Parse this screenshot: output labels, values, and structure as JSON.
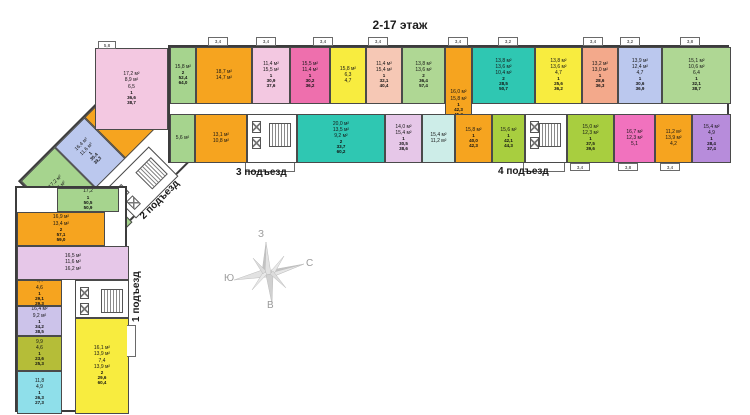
{
  "title": "2-17 этаж",
  "entrance_labels": {
    "e1": "1 подъезд",
    "e2": "2 подъезд",
    "e3": "3 подъезд",
    "e4": "4 подъезд"
  },
  "compass": {
    "top": "З",
    "right": "С",
    "left": "Ю",
    "bottom": "В"
  },
  "palette": {
    "wall": "#3c3c3c",
    "orange": "#F6A41F",
    "lightpink": "#F3C8E1",
    "hotpink": "#EE6FAD",
    "yellow": "#F8EC3F",
    "peach": "#F6C8B5",
    "coral": "#F3A98B",
    "lightgreen": "#AFD794",
    "green": "#A6D48E",
    "lime": "#A8CE3F",
    "olive": "#B5BD38",
    "teal": "#2FC7B2",
    "palecyan": "#CDEDE8",
    "cyan": "#8FDFEA",
    "periwinkle": "#BBC8EE",
    "lavender": "#CCC3EA",
    "lilac": "#E6C7E8",
    "purple": "#B78CDB",
    "magenta": "#F172BE"
  },
  "plan": {
    "top_wing": {
      "rect": [
        168,
        45,
        561,
        118
      ],
      "cells": [
        {
          "c": "#A6D48E",
          "r": [
            0,
            0,
            26,
            57
          ],
          "l": [
            "15,8 м²"
          ],
          "t": "2\n52,4\n64,0"
        },
        {
          "c": "#F6A41F",
          "r": [
            26,
            0,
            56,
            57
          ],
          "l": [
            "18,7 м²",
            "14,7 м²"
          ],
          "t": ""
        },
        {
          "c": "#F3C8E1",
          "r": [
            82,
            0,
            38,
            57
          ],
          "l": [
            "11,4 м²",
            "15,5 м²"
          ],
          "t": "1\n30,9\n37,6"
        },
        {
          "c": "#EE6FAD",
          "r": [
            120,
            0,
            40,
            57
          ],
          "l": [
            "15,5 м²",
            "11,4 м²"
          ],
          "t": "1\n30,2\n36,2"
        },
        {
          "c": "#F8EC3F",
          "r": [
            160,
            0,
            36,
            57
          ],
          "l": [
            "15,8 м²",
            "6,3",
            "4,7"
          ],
          "t": ""
        },
        {
          "c": "#F6C8B5",
          "r": [
            196,
            0,
            36,
            57
          ],
          "l": [
            "11,4 м²",
            "15,4 м²"
          ],
          "t": "1\n32,1\n40,4"
        },
        {
          "c": "#AFD794",
          "r": [
            232,
            0,
            43,
            57
          ],
          "l": [
            "13,8 м²",
            "13,6 м²"
          ],
          "t": "2\n36,4\n57,4"
        },
        {
          "c": "#F6A41F",
          "r": [
            275,
            0,
            27,
            114
          ],
          "l": [
            "16,0 м²",
            "15,8 м²"
          ],
          "t": "1\n42,3\n45,3"
        },
        {
          "c": "#2FC7B2",
          "r": [
            302,
            0,
            63,
            57
          ],
          "l": [
            "13,8 м²",
            "13,6 м²",
            "10,4 м²"
          ],
          "t": "2\n28,5\n50,7"
        },
        {
          "c": "#F8EC3F",
          "r": [
            365,
            0,
            47,
            57
          ],
          "l": [
            "13,8 м²",
            "13,6 м²",
            "4,7"
          ],
          "t": "1\n25,6\n36,2"
        },
        {
          "c": "#F3A98B",
          "r": [
            412,
            0,
            36,
            57
          ],
          "l": [
            "13,2 м²",
            "13,0 м²"
          ],
          "t": "1\n28,6\n36,3"
        },
        {
          "c": "#BBC8EE",
          "r": [
            448,
            0,
            44,
            57
          ],
          "l": [
            "13,9 м²",
            "12,4 м²",
            "4,7"
          ],
          "t": "1\n30,6\n36,9"
        },
        {
          "c": "#AFD794",
          "r": [
            492,
            0,
            69,
            57
          ],
          "l": [
            "15,1 м²",
            "10,6 м²",
            "6,4"
          ],
          "t": "1\n32,1\n38,7"
        },
        {
          "c": "#A6D48E",
          "r": [
            0,
            67,
            25,
            49
          ],
          "l": [
            "5,6 м²"
          ],
          "t": ""
        },
        {
          "c": "#F6A41F",
          "r": [
            25,
            67,
            52,
            49
          ],
          "l": [
            "13,1 м²",
            "10,8 м²"
          ],
          "t": ""
        },
        {
          "c": "#2FC7B2",
          "r": [
            127,
            67,
            88,
            49
          ],
          "l": [
            "20,0 м²",
            "13,5 м²",
            "9,2 м²"
          ],
          "t": "2\n33,7\n60,2"
        },
        {
          "c": "#E6C7E8",
          "r": [
            215,
            67,
            37,
            49
          ],
          "l": [
            "14,0 м²",
            "15,4 м²"
          ],
          "t": "1\n30,5\n38,6"
        },
        {
          "c": "#CDEDE8",
          "r": [
            252,
            67,
            33,
            49
          ],
          "l": [
            "15,4 м²",
            "11,2 м²"
          ],
          "t": ""
        },
        {
          "c": "#F6A41F",
          "r": [
            285,
            67,
            37,
            49
          ],
          "l": [
            "15,8 м²"
          ],
          "t": "1\n40,0\n42,3"
        },
        {
          "c": "#A8CE3F",
          "r": [
            322,
            67,
            33,
            49
          ],
          "l": [
            "15,6 м²"
          ],
          "t": "1\n42,1\n44,3"
        },
        {
          "c": "#A8CE3F",
          "r": [
            397,
            67,
            47,
            49
          ],
          "l": [
            "15,0 м²",
            "12,3 м²"
          ],
          "t": "1\n37,5\n39,6"
        },
        {
          "c": "#F172BE",
          "r": [
            444,
            67,
            41,
            49
          ],
          "l": [
            "16,7 м²",
            "12,3 м²",
            "5,1"
          ],
          "t": ""
        },
        {
          "c": "#F6A41F",
          "r": [
            485,
            67,
            37,
            49
          ],
          "l": [
            "11,2 м²",
            "13,9 м²",
            "4,2"
          ],
          "t": ""
        },
        {
          "c": "#B78CDB",
          "r": [
            522,
            67,
            39,
            49
          ],
          "l": [
            "15,4 м²",
            "4,9"
          ],
          "t": "1\n28,4\n37,4"
        }
      ],
      "cores": [
        {
          "r": [
            77,
            67,
            50,
            49
          ]
        },
        {
          "r": [
            355,
            67,
            42,
            49
          ]
        }
      ],
      "balconies_top": [
        {
          "x": 40,
          "label": "3,4"
        },
        {
          "x": 88,
          "label": "3,4"
        },
        {
          "x": 145,
          "label": "3,4"
        },
        {
          "x": 200,
          "label": "3,4"
        },
        {
          "x": 280,
          "label": "3,4"
        },
        {
          "x": 330,
          "label": "3,2"
        },
        {
          "x": 415,
          "label": "3,4"
        },
        {
          "x": 452,
          "label": "3,2"
        },
        {
          "x": 512,
          "label": "3,8"
        }
      ],
      "balconies_bottom": [
        {
          "x": 402,
          "label": "3,4"
        },
        {
          "x": 450,
          "label": "3,8"
        },
        {
          "x": 492,
          "label": "3,4"
        }
      ]
    },
    "junction": {
      "cells": [
        {
          "c": "#F3C8E1",
          "r": [
            95,
            48,
            73,
            82
          ],
          "l": [
            "17,2 м²",
            "8,9 м²",
            "6,5"
          ],
          "t": "1\n36,6\n38,7"
        }
      ],
      "balconies": [
        {
          "r": [
            98,
            41,
            18,
            8
          ],
          "label": "5,8"
        }
      ]
    },
    "diagonal_wing": {
      "cells": [
        {
          "c": "#A6D48E",
          "r": [
            0,
            0,
            48,
            58
          ],
          "l": [
            "17,2 м²",
            "8,6 м²"
          ],
          "t": ""
        },
        {
          "c": "#BBC8EE",
          "r": [
            48,
            0,
            42,
            58
          ],
          "l": [
            "16,4 м²",
            "11,6 м²"
          ],
          "t": "1\n35,4\n39,3"
        },
        {
          "c": "#F6A41F",
          "r": [
            90,
            0,
            45,
            58
          ],
          "l": [
            "16,5 м²",
            "11,6 м²",
            "4,3"
          ],
          "t": ""
        },
        {
          "c": "#A6D48E",
          "r": [
            0,
            66,
            50,
            42
          ],
          "l": [
            "5,8 м²"
          ],
          "t": ""
        }
      ],
      "cores": [
        {
          "r": [
            55,
            66,
            60,
            42
          ]
        }
      ]
    },
    "vertical_wing": {
      "cells": [
        {
          "c": "#A6D48E",
          "r": [
            40,
            0,
            62,
            24
          ],
          "l": [
            "17,2"
          ],
          "t": "1\n50,5\n50,9"
        },
        {
          "c": "#F6A41F",
          "r": [
            0,
            24,
            88,
            34
          ],
          "l": [
            "16,9 м²",
            "13,4 м²"
          ],
          "t": "2\n57,1\n59,0"
        },
        {
          "c": "#E6C7E8",
          "r": [
            0,
            58,
            112,
            34
          ],
          "l": [
            "16,5 м²",
            "11,6 м²",
            "16,2 м²"
          ],
          "t": ""
        },
        {
          "c": "#F6A41F",
          "r": [
            0,
            92,
            45,
            26
          ],
          "l": [
            "4,4",
            "4,6"
          ],
          "t": "1\n29,1\n29,3"
        },
        {
          "c": "#CCC3EA",
          "r": [
            0,
            118,
            45,
            30
          ],
          "l": [
            "16,4 м²",
            "9,2 м²"
          ],
          "t": "1\n34,2\n38,5"
        },
        {
          "c": "#B5BD38",
          "r": [
            0,
            148,
            45,
            35
          ],
          "l": [
            "9,9",
            "4,6"
          ],
          "t": "1\n23,6\n25,3"
        },
        {
          "c": "#8FDFEA",
          "r": [
            0,
            183,
            45,
            43
          ],
          "l": [
            "11,8",
            "4,9"
          ],
          "t": "1\n26,3\n27,3"
        },
        {
          "c": "#F8EC3F",
          "r": [
            58,
            130,
            54,
            96
          ],
          "l": [
            "16,1 м²",
            "13,9 м²",
            "7,4",
            "13,9 м²"
          ],
          "t": "2\n29,6\n60,4"
        }
      ],
      "cores": [
        {
          "r": [
            58,
            92,
            54,
            38
          ]
        }
      ]
    }
  }
}
